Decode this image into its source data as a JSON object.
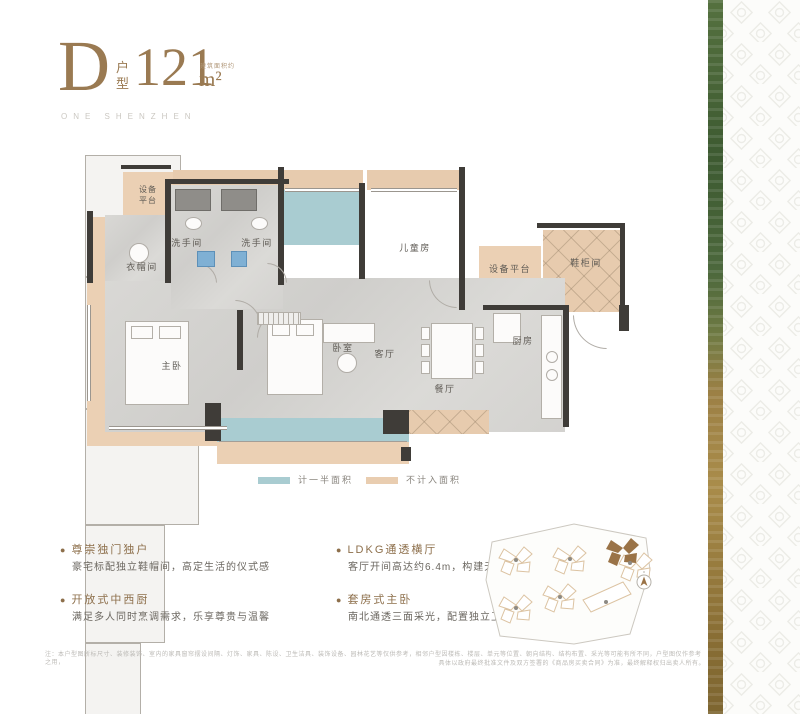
{
  "header": {
    "type_letter": "D",
    "type_label": "户型",
    "area_value": "121",
    "area_unit": "m²",
    "area_note": "建筑面积约",
    "subtitle": "ONE SHENZHEN"
  },
  "plan": {
    "rooms": {
      "equip_left": "设备平台",
      "bath_1": "洗手间",
      "bath_2": "洗手间",
      "cloakroom": "衣帽间",
      "children": "儿童房",
      "equip_right": "设备平台",
      "shoe_cabinet": "鞋柜间",
      "master": "主卧",
      "bedroom": "卧室",
      "living": "客厅",
      "dining": "餐厅",
      "kitchen": "厨房"
    }
  },
  "legend": {
    "half_label": "计一半面积",
    "half_color": "#a9ccd1",
    "excluded_label": "不计入面积",
    "excluded_color": "#e9cdb0"
  },
  "features": [
    {
      "title": "尊崇独门独户",
      "desc": "豪宅标配独立鞋帽间，高定生活的仪式感"
    },
    {
      "title": "开放式中西厨",
      "desc": "满足多人同时烹调需求，乐享尊贵与温馨"
    },
    {
      "title": "LDKG通透横厅",
      "desc": "客厅开间高达约6.4m，构建无界家庭交流场"
    },
    {
      "title": "套房式主卧",
      "desc": "南北通透三面采光，配置独立卫浴及衣帽间"
    }
  ],
  "disclaimer": {
    "line1": "注：本户型图所标尺寸、装修装饰、室内的家具窗帘摆设间隔、灯饰、家具、陈设、卫生洁具、装饰设备、园林花艺等仅供参考，相邻户型因楼栋、楼层、单元等位置、朝向结构、结构布置、采光等可能有所不同，户型图仅作参考之用，",
    "line2": "具体以政府最终批准文件及双方签署的《商品房买卖合同》为准，最终解释权归出卖人所有。"
  },
  "colors": {
    "accent_brown": "#9a7a52",
    "wall": "#3f3c38",
    "tan_excluded": "#ebd0b4",
    "teal_half": "#a9ccd1",
    "strip_green": "#4a6538",
    "strip_gold": "#9c7f42"
  }
}
